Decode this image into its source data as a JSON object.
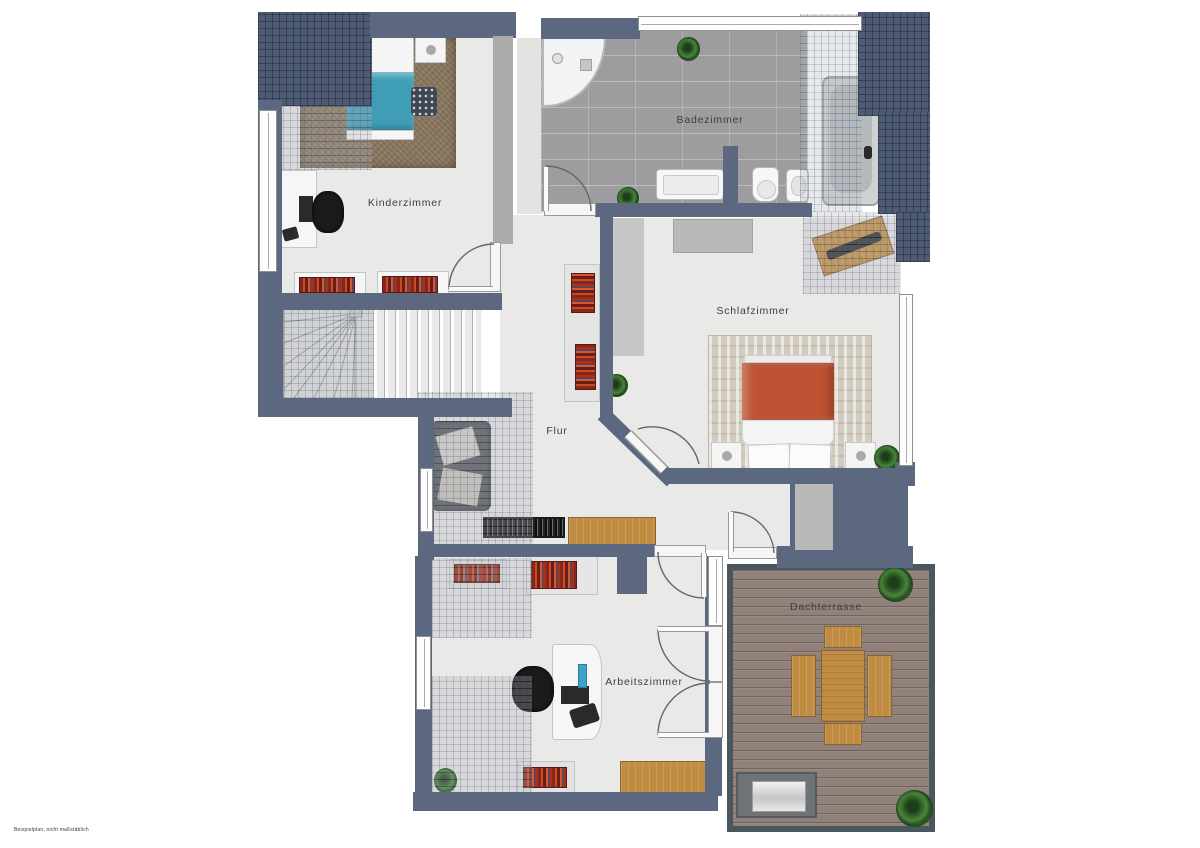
{
  "floorplan": {
    "title": "Obergeschoss Grundriss",
    "rooms": {
      "kinderzimmer": {
        "label": "Kinderzimmer"
      },
      "badezimmer": {
        "label": "Badezimmer"
      },
      "schlafzimmer": {
        "label": "Schlafzimmer"
      },
      "flur": {
        "label": "Flur"
      },
      "arbeitszimmer": {
        "label": "Arbeitszimmer"
      },
      "dachterrasse": {
        "label": "Dachterrasse"
      }
    },
    "disclaimer": "Beispielplan, nicht maßstäblich",
    "colors": {
      "wall": "#5b6880",
      "roof_tile": "#4e5b74",
      "floor": "#e9e9e8",
      "bath_tile": "#9d9da0",
      "deck": "#90817a",
      "deck_border": "#4a575d",
      "bed_teal": "#3f9db6",
      "bed_red": "#bf5233",
      "wood": "#c08c42",
      "rug_brown": "#8b7961"
    }
  }
}
